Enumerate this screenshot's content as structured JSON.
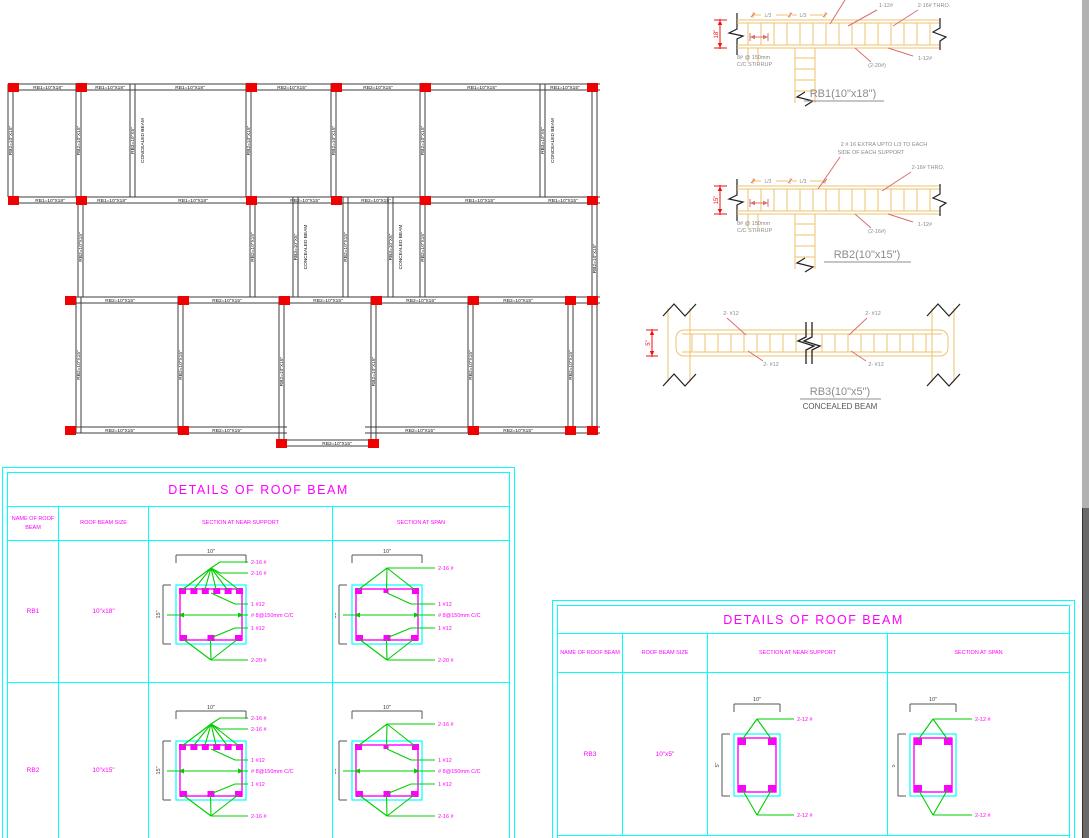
{
  "plan": {
    "rb2_label": "RB2=10\"X15\"",
    "rb3_label": "RB3=10\"X5\"",
    "concealed_label": "CONCEALED BEAM",
    "h_beams": [
      [
        8,
        600,
        84
      ],
      [
        8,
        600,
        197
      ],
      [
        65,
        600,
        297
      ],
      [
        65,
        287,
        427
      ],
      [
        365,
        600,
        427
      ],
      [
        276,
        379,
        440
      ]
    ],
    "v_beams": [
      [
        8,
        84,
        197,
        0
      ],
      [
        76,
        84,
        197,
        0
      ],
      [
        130,
        84,
        197,
        1
      ],
      [
        246,
        84,
        197,
        0
      ],
      [
        331,
        84,
        197,
        0
      ],
      [
        420,
        84,
        197,
        0
      ],
      [
        540,
        84,
        197,
        1
      ],
      [
        592,
        84,
        433,
        0
      ],
      [
        78,
        197,
        297,
        0
      ],
      [
        250,
        197,
        297,
        0
      ],
      [
        293,
        197,
        297,
        1
      ],
      [
        343,
        197,
        297,
        0
      ],
      [
        388,
        197,
        297,
        1
      ],
      [
        420,
        197,
        297,
        0
      ],
      [
        76,
        297,
        433,
        0
      ],
      [
        178,
        297,
        433,
        0
      ],
      [
        279,
        297,
        446,
        0
      ],
      [
        371,
        297,
        446,
        0
      ],
      [
        468,
        297,
        433,
        0
      ],
      [
        568,
        297,
        433,
        0
      ]
    ],
    "labels_h": [
      [
        48,
        84,
        "RB1=10\"X18\""
      ],
      [
        110,
        84,
        "RB1=10\"X18\""
      ],
      [
        190,
        84,
        "RB1=10\"X18\""
      ],
      [
        292,
        84,
        "RB2=10\"X15\""
      ],
      [
        378,
        84,
        "RB2=10\"X15\""
      ],
      [
        482,
        84,
        "RB1=10\"X15\""
      ],
      [
        565,
        84,
        "RB1=10\"X15\""
      ],
      [
        50,
        197,
        "RB1=10\"X18\""
      ],
      [
        112,
        197,
        "RB1=10\"X18\""
      ],
      [
        193,
        197,
        "RB1=10\"X18\""
      ],
      [
        305,
        197,
        "RB2=10\"X15\""
      ],
      [
        376,
        197,
        "RB2=10\"X15\""
      ],
      [
        480,
        197,
        "RB1=10\"X15\""
      ],
      [
        563,
        197,
        "RB1=10\"X15\""
      ],
      [
        120,
        297,
        "RB2=10\"X15\""
      ],
      [
        227,
        297,
        "RB2=10\"X15\""
      ],
      [
        328,
        297,
        "RB2=10\"X15\""
      ],
      [
        421,
        297,
        "RB2=10\"X15\""
      ],
      [
        518,
        297,
        "RB2=10\"X15\""
      ],
      [
        120,
        427,
        "RB2=10\"X15\""
      ],
      [
        227,
        427,
        "RB2=10\"X15\""
      ],
      [
        420,
        427,
        "RB2=10\"X15\""
      ],
      [
        518,
        427,
        "RB2=10\"X15\""
      ],
      [
        337,
        440,
        "RB2=10\"X15\""
      ]
    ],
    "columns": [
      [
        13,
        84
      ],
      [
        81,
        84
      ],
      [
        251,
        84
      ],
      [
        336,
        84
      ],
      [
        425,
        84
      ],
      [
        592,
        84
      ],
      [
        13,
        197
      ],
      [
        81,
        197
      ],
      [
        251,
        197
      ],
      [
        336,
        197
      ],
      [
        425,
        197
      ],
      [
        592,
        197
      ],
      [
        70,
        297
      ],
      [
        183,
        297
      ],
      [
        284,
        297
      ],
      [
        376,
        297
      ],
      [
        473,
        297
      ],
      [
        570,
        297
      ],
      [
        592,
        297
      ],
      [
        70,
        427
      ],
      [
        183,
        427
      ],
      [
        473,
        427
      ],
      [
        570,
        427
      ],
      [
        592,
        427
      ],
      [
        281,
        440
      ],
      [
        373,
        440
      ]
    ]
  },
  "details": {
    "rb1": {
      "title": "RB1(10\"x18\")",
      "depth_dim": "18\"",
      "l3": "L/3",
      "top_labels": [
        "1-12#",
        "2-16# THRO."
      ],
      "stirrup_label": [
        "8# @ 150mm",
        "C/C STIRRUP"
      ],
      "bottom_labels": [
        "(2-20#)",
        "1-12#"
      ]
    },
    "rb2": {
      "title": "RB2(10\"x15\")",
      "depth_dim": "15\"",
      "l3": "L/3",
      "note": [
        "2 # 16 EXTRA UPTO L/3 TO EACH",
        "SIDE OF EACH SUPPORT"
      ],
      "top_label": "2-16# THRO.",
      "stirrup_label": [
        "8# @ 150mm",
        "C/C STIRRUP"
      ],
      "bottom_labels": [
        "(2-16#)",
        "1-12#"
      ]
    },
    "rb3": {
      "title": "RB3(10\"x5\")",
      "subtitle": "CONCEALED BEAM",
      "depth_dim": "5\"",
      "bar_labels": [
        "2- #12",
        "2- #12",
        "2- #12",
        "2- #12"
      ]
    }
  },
  "table1": {
    "title": "DETAILS OF  ROOF BEAM",
    "headers": [
      "NAME OF  ROOF BEAM",
      "ROOF BEAM SIZE",
      "SECTION AT NEAR SUPPORT",
      "SECTION AT SPAN"
    ],
    "rows": [
      {
        "name": "RB1",
        "size": "10\"x18\"",
        "near": {
          "dim_w": "10\"",
          "dim_h": "15\"",
          "bars_top": 6,
          "bars_bottom": 3,
          "top_labels": [
            "2-16 #",
            "2-16 #"
          ],
          "mid_labels": [
            "1 #12",
            "# 8@150mm C/C",
            "1 #12"
          ],
          "bottom_label": "2-20 #"
        },
        "span": {
          "dim_w": "10\"",
          "dim_h": "15\"",
          "bars_top": 3,
          "bars_bottom": 3,
          "top_labels": [
            "2-16 #"
          ],
          "mid_labels": [
            "1 #12",
            "# 8@150mm C/C",
            "1 #12"
          ],
          "bottom_label": "2-20 #"
        }
      },
      {
        "name": "RB2",
        "size": "10\"x15\"",
        "near": {
          "dim_w": "10\"",
          "dim_h": "15\"",
          "bars_top": 6,
          "bars_bottom": 3,
          "top_labels": [
            "2-16 #",
            "2-16 #"
          ],
          "mid_labels": [
            "1 #12",
            "# 8@150mm C/C",
            "1 #12"
          ],
          "bottom_label": "2-16 #"
        },
        "span": {
          "dim_w": "10\"",
          "dim_h": "15\"",
          "bars_top": 3,
          "bars_bottom": 3,
          "top_labels": [
            "2-16 #"
          ],
          "mid_labels": [
            "1 #12",
            "# 8@150mm C/C",
            "1 #12"
          ],
          "bottom_label": "2-16 #"
        }
      }
    ]
  },
  "table2": {
    "title": "DETAILS OF  ROOF BEAM",
    "headers": [
      "NAME OF  ROOF BEAM",
      "ROOF BEAM SIZE",
      "SECTION AT NEAR SUPPORT",
      "SECTION AT SPAN"
    ],
    "rows": [
      {
        "name": "RB3",
        "size": "10\"x5\"",
        "near": {
          "dim_w": "10\"",
          "dim_h": "5\"",
          "top_label": "2-12 #",
          "bottom_label": "2-12 #"
        },
        "span": {
          "dim_w": "10\"",
          "dim_h": "5\"",
          "top_label": "2-12 #",
          "bottom_label": "2-12 #"
        }
      }
    ]
  }
}
